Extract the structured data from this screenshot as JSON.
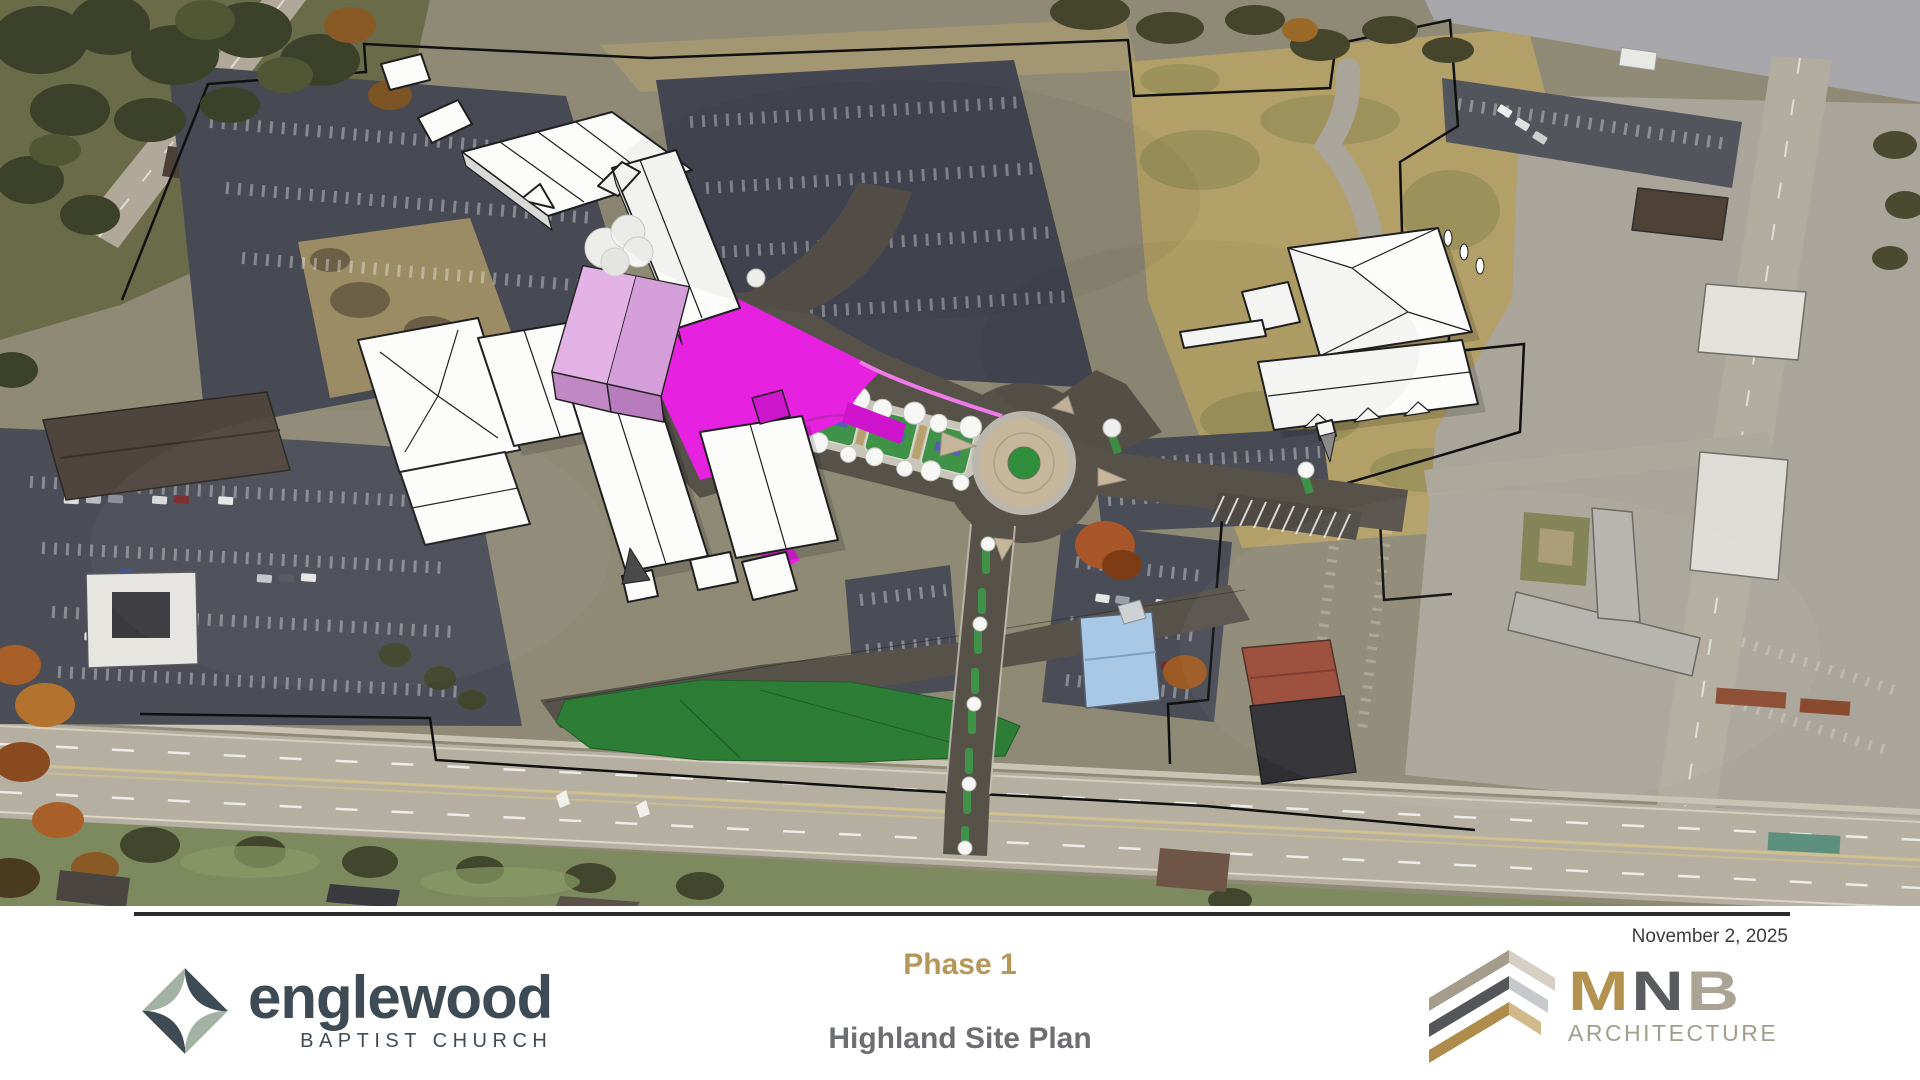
{
  "slide": {
    "date": "November 2, 2025",
    "phase": "Phase 1",
    "subtitle": "Highland Site Plan"
  },
  "footer": {
    "englewood": {
      "word": "englewood",
      "tagline": "BAPTIST CHURCH"
    },
    "mnb": {
      "m": "M",
      "n": "N",
      "b": "B",
      "tagline": "ARCHITECTURE"
    }
  },
  "colors": {
    "accent_gold": "#b5975a",
    "title_gray": "#6d6e71",
    "englewood_slate": "#3e4b54",
    "englewood_sage": "#a3b2a4",
    "mnb_gold": "#b3914f",
    "mnb_dark_gray": "#595b5e",
    "mnb_taupe": "#aba495",
    "phase1_building_pink": "#dcaade",
    "phase1_plaza_magenta": "#e621e0",
    "new_lawn_green": "#2e7d36",
    "new_drive_asphalt": "#56524a",
    "roundabout_apron_tan": "#c6b69c",
    "existing_building_white": "#fcfcfb",
    "property_boundary_black": "#101010"
  },
  "map_legend": {
    "features": [
      "aerial-photo-context",
      "property-boundary-line",
      "phase1-new-building",
      "entry-boulevard-with-medians",
      "roundabout",
      "new-south-drive",
      "new-lawn",
      "existing-church-campus",
      "east-campus-buildings",
      "parking-lots",
      "highland-avenue"
    ]
  }
}
